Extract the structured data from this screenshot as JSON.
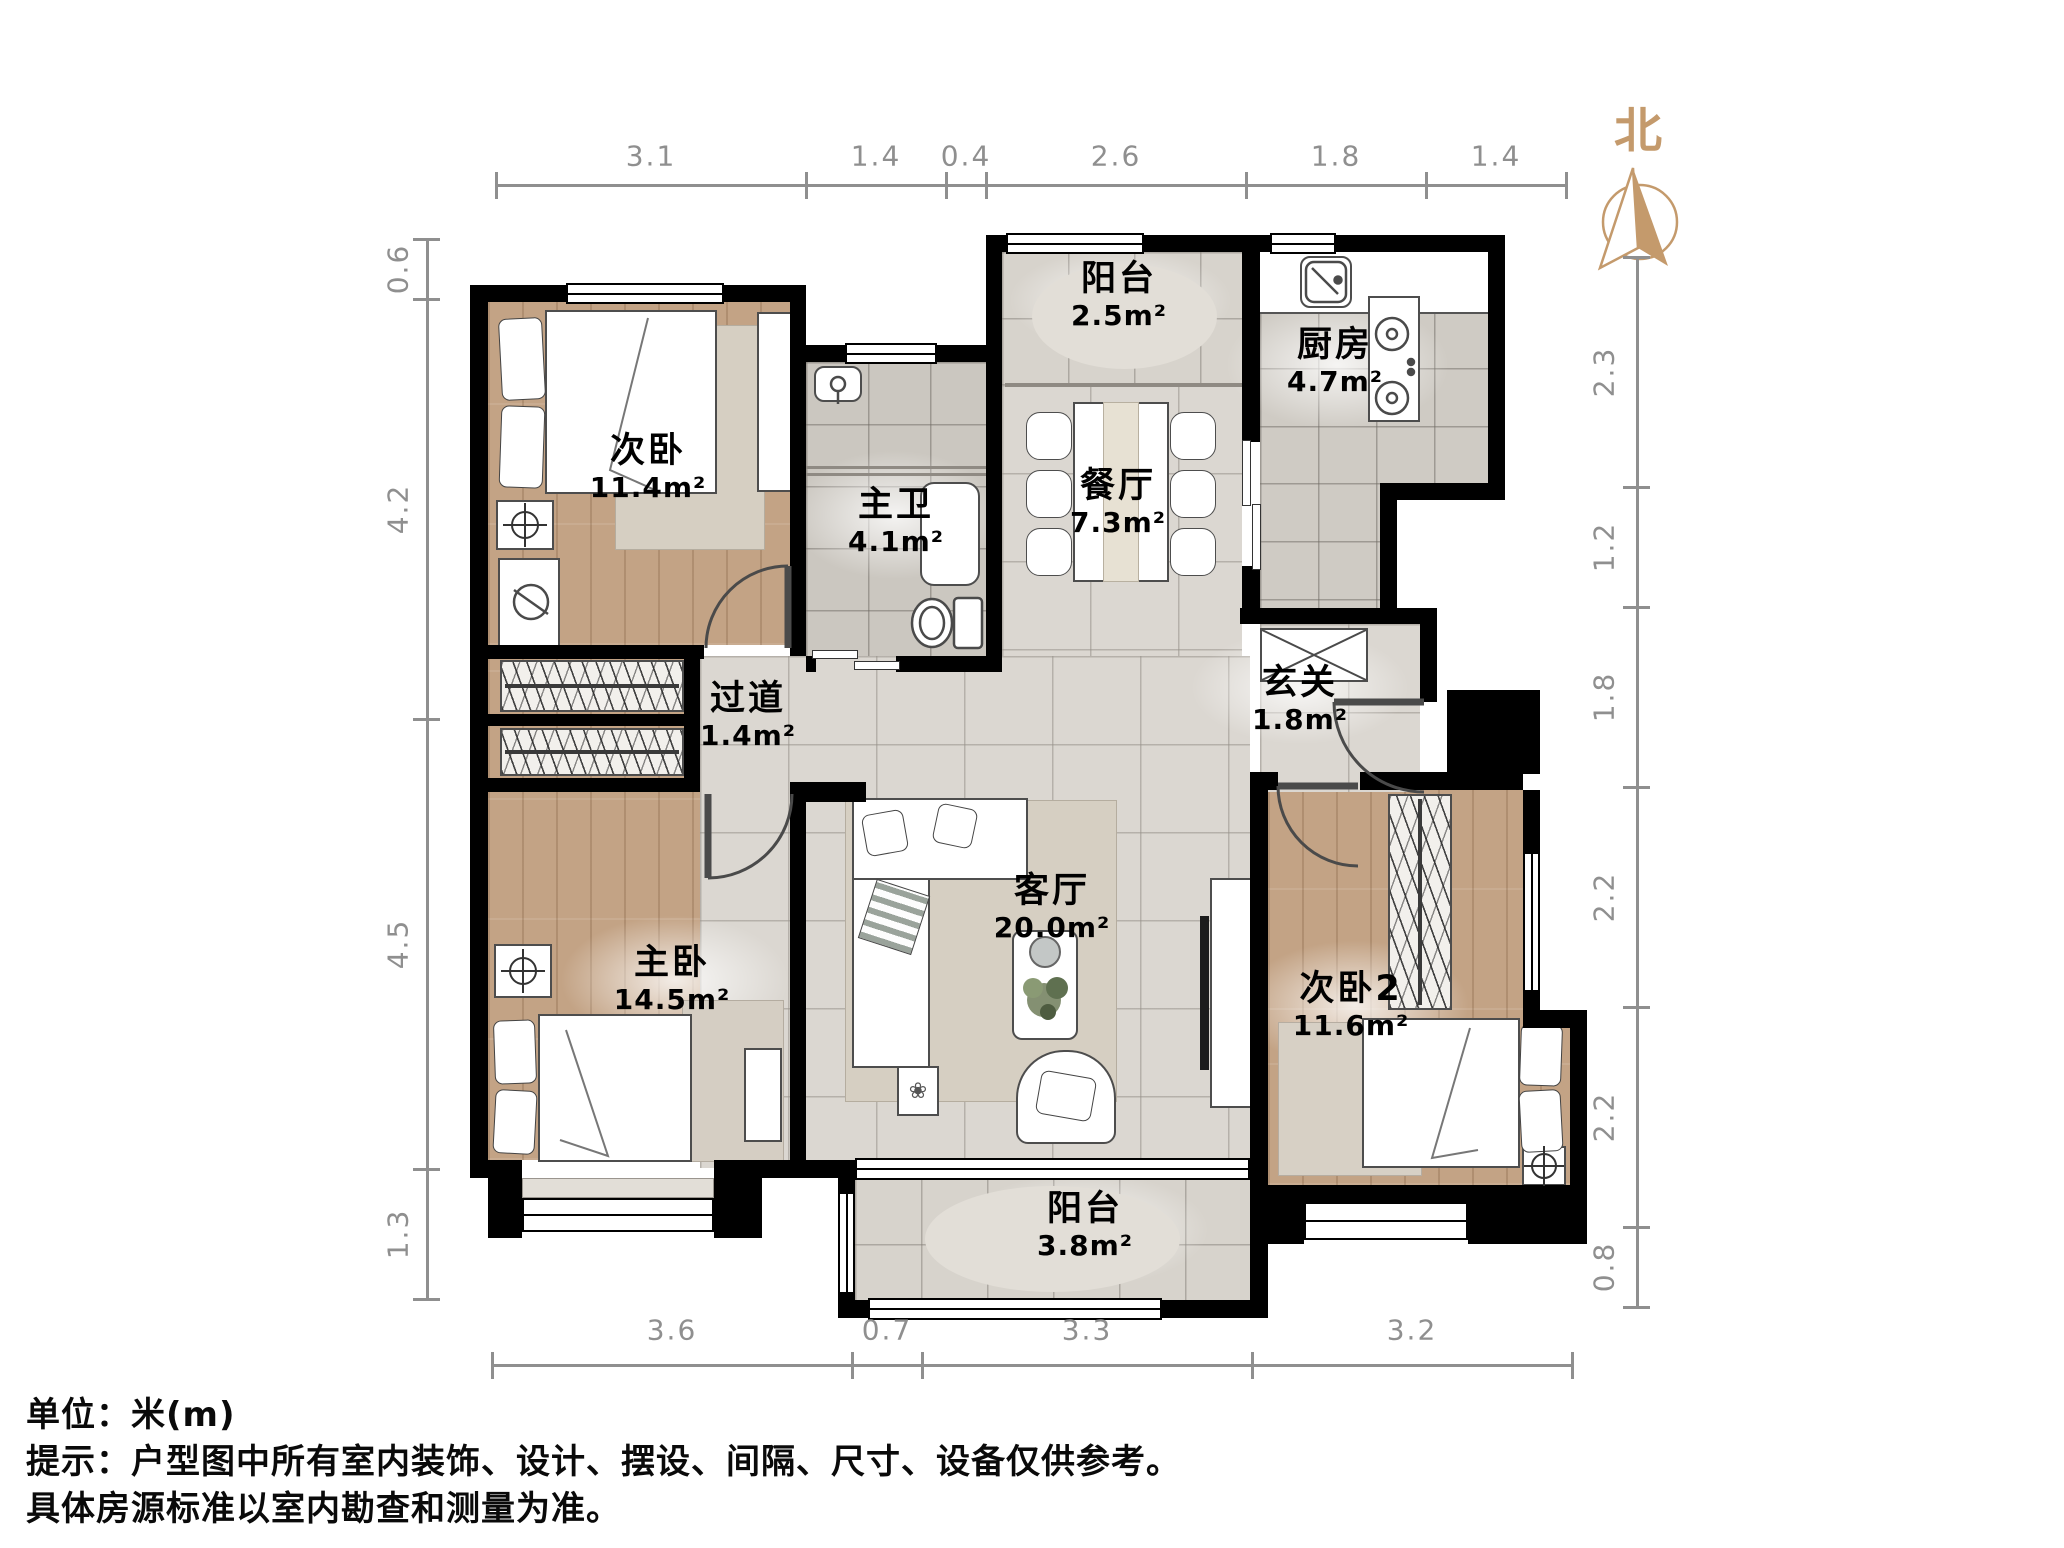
{
  "compass": {
    "label": "北"
  },
  "rooms": {
    "bedroom_n": {
      "name": "次卧",
      "area": "11.4m²"
    },
    "bath": {
      "name": "主卫",
      "area": "4.1m²"
    },
    "balcony_n": {
      "name": "阳台",
      "area": "2.5m²"
    },
    "kitchen": {
      "name": "厨房",
      "area": "4.7m²"
    },
    "dining": {
      "name": "餐厅",
      "area": "7.3m²"
    },
    "foyer": {
      "name": "玄关",
      "area": "1.8m²"
    },
    "hallway": {
      "name": "过道",
      "area": "1.4m²"
    },
    "master": {
      "name": "主卧",
      "area": "14.5m²"
    },
    "living": {
      "name": "客厅",
      "area": "20.0m²"
    },
    "bedroom_s": {
      "name": "次卧2",
      "area": "11.6m²"
    },
    "balcony_s": {
      "name": "阳台",
      "area": "3.8m²"
    }
  },
  "dimensions": {
    "top": [
      "3.1",
      "1.4",
      "0.4",
      "2.6",
      "1.8",
      "1.4"
    ],
    "left": [
      "0.6",
      "4.2",
      "4.5",
      "1.3"
    ],
    "right": [
      "2.3",
      "1.2",
      "1.8",
      "2.2",
      "2.2",
      "0.8"
    ],
    "bottom": [
      "3.6",
      "0.7",
      "3.3",
      "3.2"
    ]
  },
  "notes": [
    "单位：米(m)",
    "提示：户型图中所有室内装饰、设计、摆设、间隔、尺寸、设备仅供参考。",
    "具体房源标准以室内勘查和测量为准。"
  ]
}
